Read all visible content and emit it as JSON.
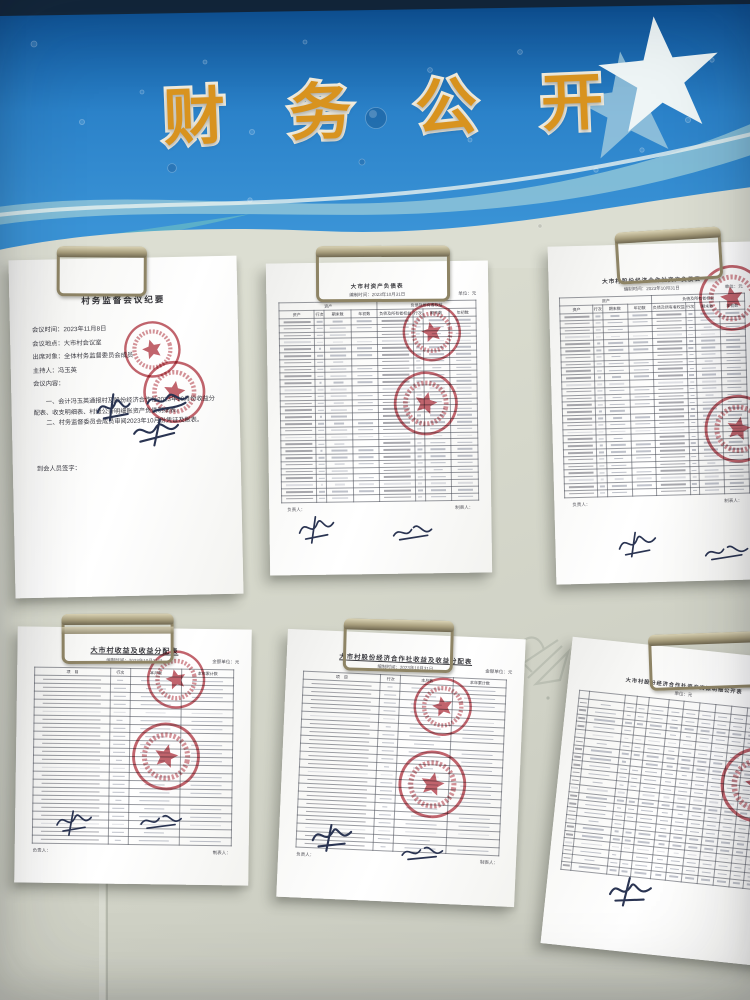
{
  "colors": {
    "banner_blue": "#1e6db8",
    "banner_blue_dark": "#0b4f93",
    "title_orange": "#d8931f",
    "board_cream": "#dcded2",
    "seal_red": "#b5414c",
    "ink_blue": "#2a3452"
  },
  "banner": {
    "title": "财务公开",
    "star_icon": "star"
  },
  "documents": [
    {
      "id": "doc1",
      "kind": "meeting-minutes",
      "title": "村务监督会议纪要",
      "lines": [
        "会议时间：2023年11月8日",
        "会议地点：大市村会议室",
        "出席对象：全体村务监督委员会成员",
        "主持人：冯玉英",
        "会议内容："
      ],
      "paragraphs": [
        "一、会计冯玉英通报村及股份经济合作社2023年10月份收益分配表、收支明细表、村级公开明细账资产负债明细表。",
        "二、村务监督委员会成员审阅2023年10月份凭证及账表。"
      ],
      "footer": "到会人员签字：",
      "seals": 2,
      "signatures": 3
    },
    {
      "id": "doc2",
      "kind": "balance-sheet",
      "title": "大市村资产负债表",
      "subtitle": "编制时间：2023年10月31日",
      "unit": "单位：元",
      "table": {
        "group_headers": [
          "资产",
          "负债及所有者权益"
        ],
        "headers": [
          "资产",
          "行次",
          "期末数",
          "年初数",
          "负债及所有者权益",
          "行次",
          "期末数",
          "年初数"
        ],
        "col_widths": [
          18,
          5,
          13.5,
          13.5,
          18,
          5,
          13.5,
          13.5
        ],
        "rows": 27
      },
      "footer_left": "负责人：",
      "footer_right": "制表人：",
      "seals": 2,
      "signatures": 2
    },
    {
      "id": "doc3",
      "kind": "balance-sheet",
      "title": "大市村股份经济合作社资产负债表",
      "subtitle": "编制时间：2023年10月31日",
      "unit": "单位：元",
      "table": {
        "group_headers": [
          "资产",
          "负债及所有者权益"
        ],
        "headers": [
          "资产",
          "行次",
          "期末数",
          "年初数",
          "负债及所有者权益",
          "行次",
          "期末数",
          "年初数"
        ],
        "col_widths": [
          18,
          5,
          13.5,
          13.5,
          18,
          5,
          13.5,
          13.5
        ],
        "rows": 27
      },
      "footer_left": "负责人：",
      "footer_right": "制表人：",
      "seals": 2,
      "signatures": 2
    },
    {
      "id": "doc4",
      "kind": "income-distribution",
      "title": "大市村收益及收益分配表",
      "subtitle": "编制时间：2023年10月31日",
      "unit": "金额单位：元",
      "table": {
        "headers": [
          "项　目",
          "行次",
          "本月数",
          "本年累计数"
        ],
        "col_widths": [
          38,
          10,
          26,
          26
        ],
        "rows": 21
      },
      "footer_left": "负责人：",
      "footer_right": "制表人：",
      "seals": 2,
      "signatures": 2
    },
    {
      "id": "doc5",
      "kind": "income-distribution",
      "title": "大市村股份经济合作社收益及收益分配表",
      "subtitle": "编制时间：2023年10月31日",
      "unit": "金额单位：元",
      "table": {
        "headers": [
          "项　目",
          "行次",
          "本月数",
          "本年累计数"
        ],
        "col_widths": [
          38,
          10,
          26,
          26
        ],
        "rows": 21
      },
      "footer_left": "负责人：",
      "footer_right": "制表人：",
      "seals": 2,
      "signatures": 2
    },
    {
      "id": "doc6",
      "kind": "asset-resource-register",
      "title": "大市村股份经济合作社资产资源明细公开表",
      "unit": "单位：元",
      "table": {
        "headers": [
          "",
          "",
          "",
          "",
          "",
          "",
          "",
          "",
          "",
          "",
          "",
          ""
        ],
        "col_widths": [
          5,
          18,
          6,
          6,
          10,
          8,
          8,
          8,
          8,
          8,
          7,
          8
        ],
        "rows": 22
      },
      "seals": 1,
      "signatures": 1
    }
  ]
}
